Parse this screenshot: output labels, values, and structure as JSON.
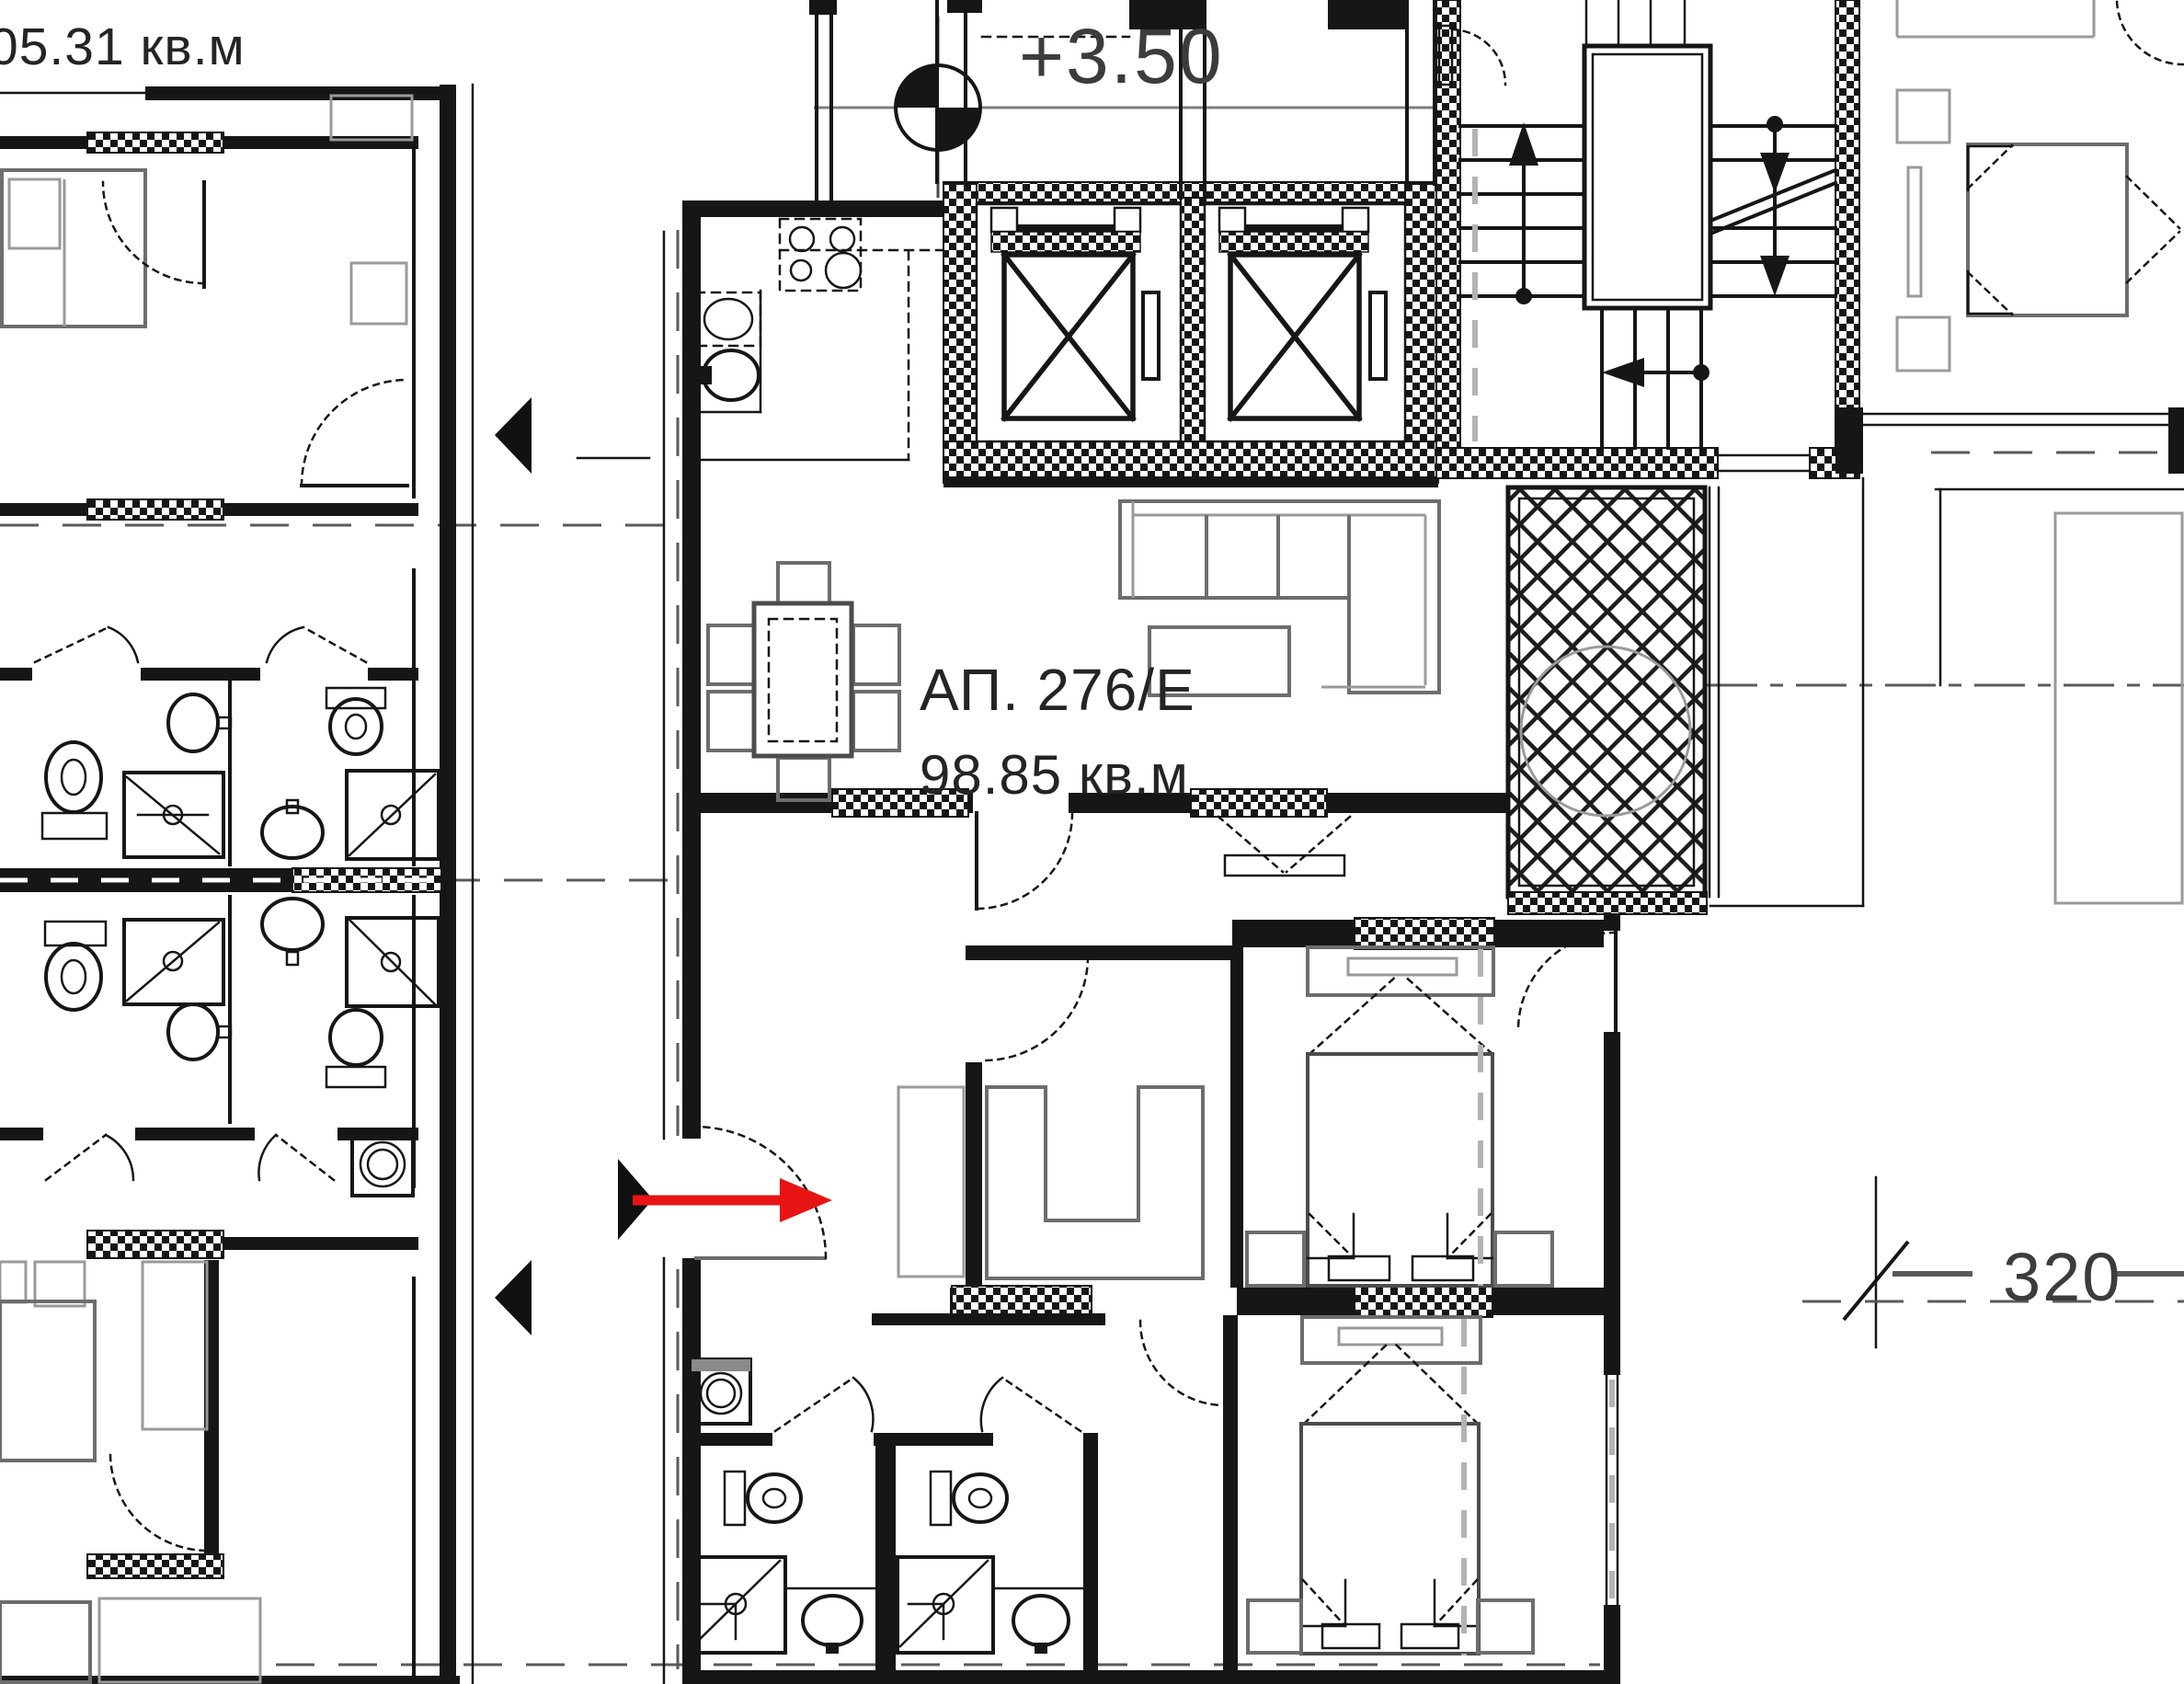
{
  "drawing": {
    "left_apartment": {
      "area_label": "05.31 кв.м"
    },
    "elevation_marker": {
      "value": "+3.50"
    },
    "apartment": {
      "id_label": "АП. 276/Е",
      "area_label": "98.85 кв.м"
    },
    "dimension": {
      "value": "320"
    },
    "colors": {
      "ink": "#161616",
      "furniture_gray": "#6d6d6d",
      "light_gray": "#9a9a9a",
      "entrance_arrow_red": "#e81414",
      "background": "#ffffff"
    }
  }
}
